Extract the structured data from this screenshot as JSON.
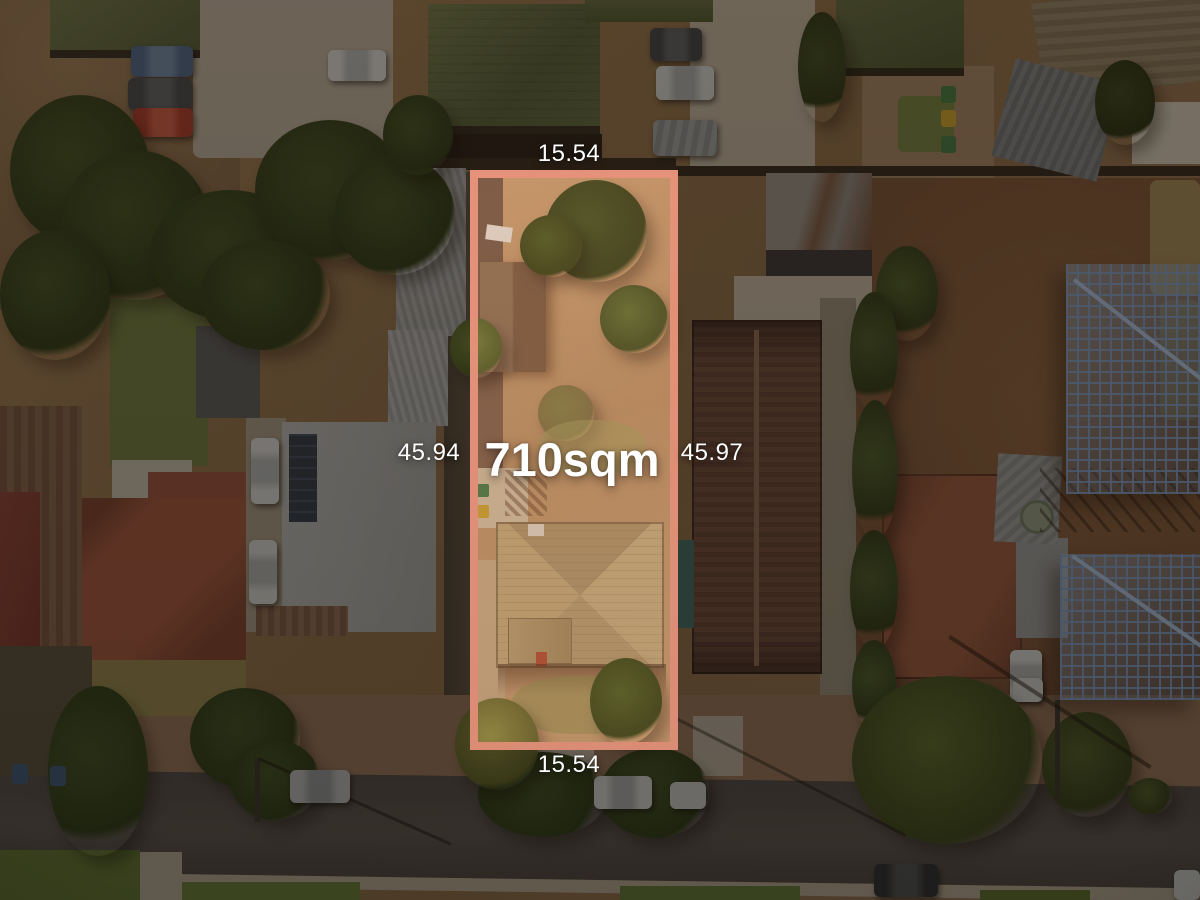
{
  "photo": {
    "description": "Aerial drone photograph of a suburban allotment with a highlighted boundary overlay",
    "label_color": "#ffffff"
  },
  "lot": {
    "area_label": "710sqm",
    "outline_color": "#F29A82",
    "dimensions": {
      "top": "15.54",
      "bottom": "15.54",
      "left": "45.94",
      "right": "45.97"
    }
  }
}
